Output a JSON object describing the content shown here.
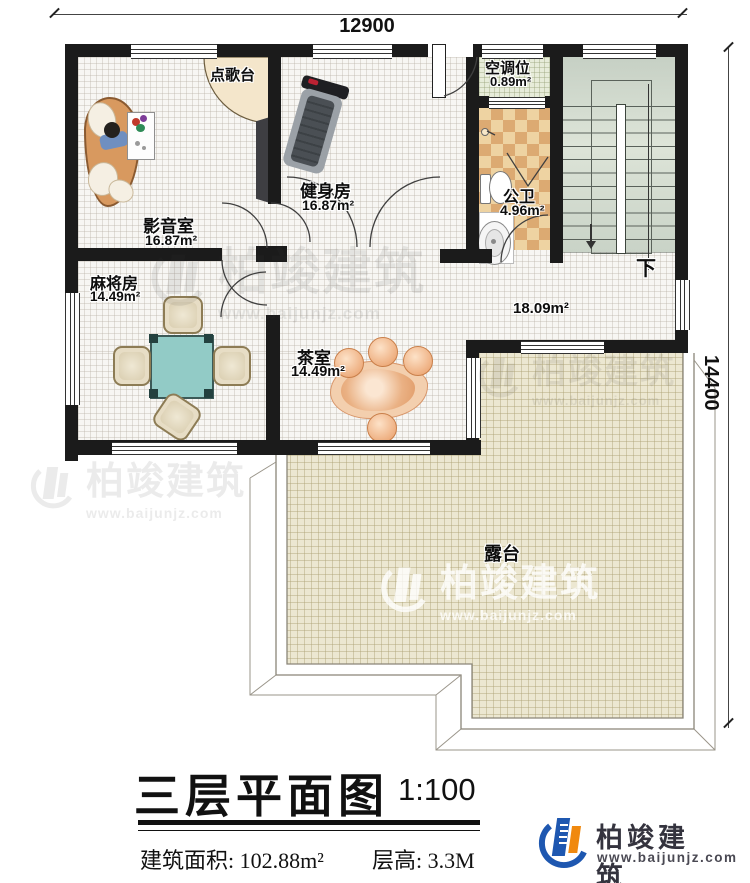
{
  "dimensions": {
    "width": "12900",
    "height": "14400"
  },
  "rooms": {
    "karaoke_station": {
      "name": "点歌台"
    },
    "media_room": {
      "name": "影音室",
      "area": "16.87m²"
    },
    "gym": {
      "name": "健身房",
      "area": "16.87m²"
    },
    "ac_unit": {
      "name": "空调位",
      "area": "0.89m²"
    },
    "public_bathroom": {
      "name": "公卫",
      "area": "4.96m²"
    },
    "mahjong_room": {
      "name": "麻将房",
      "area": "14.49m²"
    },
    "tea_room": {
      "name": "茶室",
      "area": "14.49m²"
    },
    "hall": {
      "area": "18.09m²"
    },
    "terrace": {
      "name": "露台"
    },
    "stairs": {
      "direction": "下"
    }
  },
  "title": {
    "name": "三层平面图",
    "scale": "1:100"
  },
  "stats": {
    "area_label": "建筑面积:",
    "area_value": "102.88m²",
    "floor_height_label": "层高:",
    "floor_height_value": "3.3M"
  },
  "brand": {
    "name": "柏竣建筑",
    "website": "www.baijunjz.com"
  },
  "watermark": {
    "name": "柏竣建筑",
    "website": "www.baijunjz.com"
  }
}
